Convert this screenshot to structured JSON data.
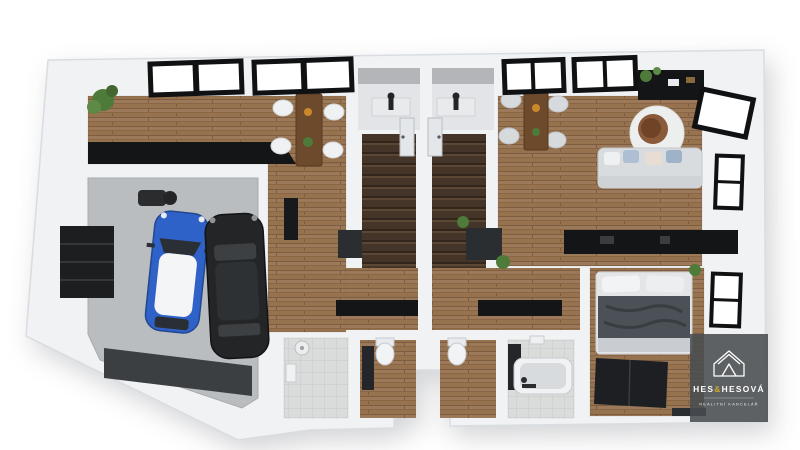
{
  "image": {
    "type": "3d-floor-plan-render",
    "description": "Top-down 3D architectural visualization of a two-unit dwelling with shared double garage, twin entry vestibules and staircases, two open living-dining-kitchen areas, bathrooms, WCs and a bedroom"
  },
  "watermark": {
    "brand_left": "HES",
    "brand_amp": "&",
    "brand_right": "HESOVÁ",
    "tagline": "REALITNÍ KANCELÁŘ",
    "panel_color": "#484c50",
    "text_color": "#ffffff",
    "amp_color": "#d2a62c",
    "icon": "house-logo-icon"
  },
  "colors": {
    "background": "#ffffff",
    "wall": "#f0f2f4",
    "wall_edge": "#d9dde1",
    "wood_floor": "#97724f",
    "stairs_dark": "#453428",
    "concrete": "#babdbf",
    "garage_door": "#3c3f42",
    "car_blue": "#2f62c8",
    "car_black": "#232527",
    "counter_black": "#141517",
    "sofa_gray": "#d9dcde",
    "tile": "#dadcdb",
    "plant_green": "#4e7a3a",
    "chair_white": "#eff1f2",
    "chair_gray": "#d6dadd",
    "rug_white": "#edefee",
    "papasan_brown": "#8a5a3a",
    "bed_blanket": "#4b5157",
    "wardrobe_dark": "#1d1f22"
  },
  "floorplan": {
    "shared_elements": [
      "double-garage",
      "blue-car",
      "black-car",
      "garage-shelving",
      "twin-entry-vestibules",
      "twin-staircases"
    ],
    "unit_left_elements": [
      "open-living-dining",
      "black-kitchen-counter",
      "wall-bookshelf",
      "corner-plant",
      "dining-table-4-chairs",
      "wall-tv",
      "hallway-sideboard",
      "tiled-bathroom-shower",
      "wc-wood-floor"
    ],
    "unit_right_elements": [
      "open-living-dining",
      "black-kitchen-console",
      "dining-table-4-chairs",
      "round-rug",
      "papasan-chair",
      "gray-sofa-pillows",
      "black-sideboard",
      "bedroom-double-bed",
      "dark-wardrobe",
      "bathroom-bathtub",
      "wc-wood-floor"
    ],
    "window_elements": [
      "top-glazing-banks",
      "right-wall-windows"
    ]
  }
}
